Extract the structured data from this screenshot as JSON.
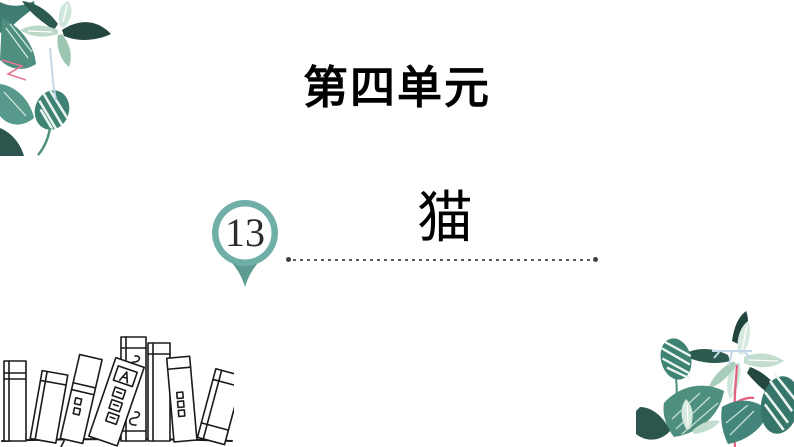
{
  "slide": {
    "unit_title": "第四单元",
    "lesson_number": "13",
    "lesson_title": "猫"
  },
  "colors": {
    "background": "#ffffff",
    "accent_teal": "#6fafa7",
    "pin_tail_teal": "#5d9b93",
    "title_text": "#000000",
    "lesson_number_text": "#2b2b2b",
    "dotted_line": "#5c5c5c",
    "leaf_dark": "#24473f",
    "leaf_mid": "#4e8f7f",
    "leaf_light": "#cfe6da",
    "stem_pink": "#e0607e",
    "stem_blue": "#c2d8e8",
    "sketch_ink": "#1a1a1a"
  },
  "decorations": {
    "top_left": "watercolor-plant-leaves",
    "bottom_right": "watercolor-plant-leaves",
    "bottom_left": "hand-drawn-book-sketch",
    "marker": "map-pin-badge"
  }
}
